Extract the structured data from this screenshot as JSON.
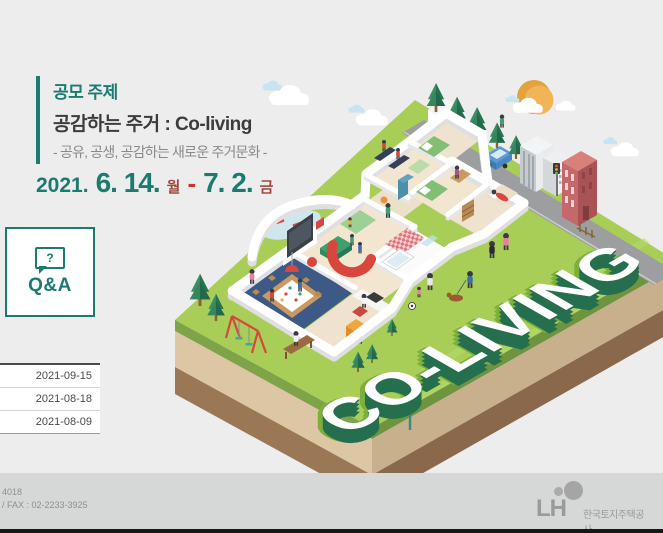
{
  "theme": {
    "teal": "#1B7B6F",
    "red": "#C0392B",
    "dark_red": "#9E4A3E",
    "page_bg": "#EDEDEE",
    "footer_bg": "#D6D7D7",
    "grass": "#A8CE58",
    "earth_tan": "#DCC6A4",
    "earth_brown": "#9A7856",
    "letter_dark_green": "#256E4E",
    "letter_bright_green": "#7DAF3D"
  },
  "contest": {
    "section_label": "공모 주제",
    "title": "공감하는 주거 : Co-living",
    "subtitle": "- 공유, 공생, 공감하는 새로운 주거문화 -",
    "period": {
      "year": "2021.",
      "start": "6. 14.",
      "start_day": "월",
      "dash": "-",
      "end": "7. 2.",
      "end_day": "금"
    }
  },
  "qa": {
    "label": "Q&A",
    "icon": "question-bubble-icon",
    "icon_glyph": "?"
  },
  "notices": {
    "rows": [
      {
        "date": "2021-09-15"
      },
      {
        "date": "2021-08-18"
      },
      {
        "date": "2021-08-09"
      }
    ]
  },
  "footer": {
    "contact_line1": "4018",
    "contact_line2": "/ FAX : 02-2233-3925",
    "logo_text": "LH",
    "logo_icon": "lh-circles-icon",
    "org_name": "한국토지주택공사"
  },
  "illustration": {
    "headline": "CO-LIVING",
    "description": "isometric co-living house cutaway with trees, road, sun and clouds"
  }
}
